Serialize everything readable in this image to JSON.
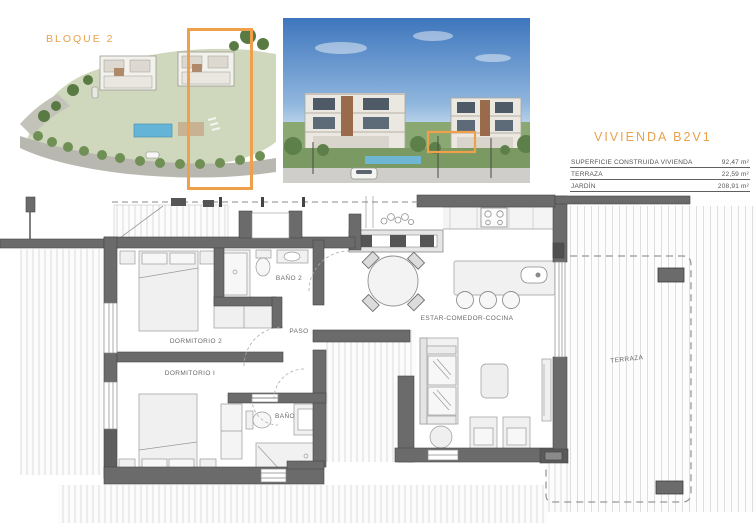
{
  "accent": {
    "orange": "#F0A04A"
  },
  "site_plan": {
    "block_label": "BLOQUE 2"
  },
  "info_panel": {
    "title": "VIVIENDA B2V1",
    "rows": [
      {
        "label": "SUPERFICIE CONSTRUIDA VIVIENDA",
        "value": "92,47 m²"
      },
      {
        "label": "TERRAZA",
        "value": "22,59 m²"
      },
      {
        "label": "JARDÍN",
        "value": "208,91 m²"
      }
    ]
  },
  "floor_plan": {
    "rooms": {
      "dormitorio_2": "DORMITORIO 2",
      "banio_2": "BAÑO 2",
      "paso": "PASO",
      "dormitorio_1": "DORMITORIO I",
      "banio": "BAÑO",
      "estar_comedor_cocina": "ESTAR-COMEDOR-COCINA",
      "terraza": "TERRAZA"
    }
  }
}
